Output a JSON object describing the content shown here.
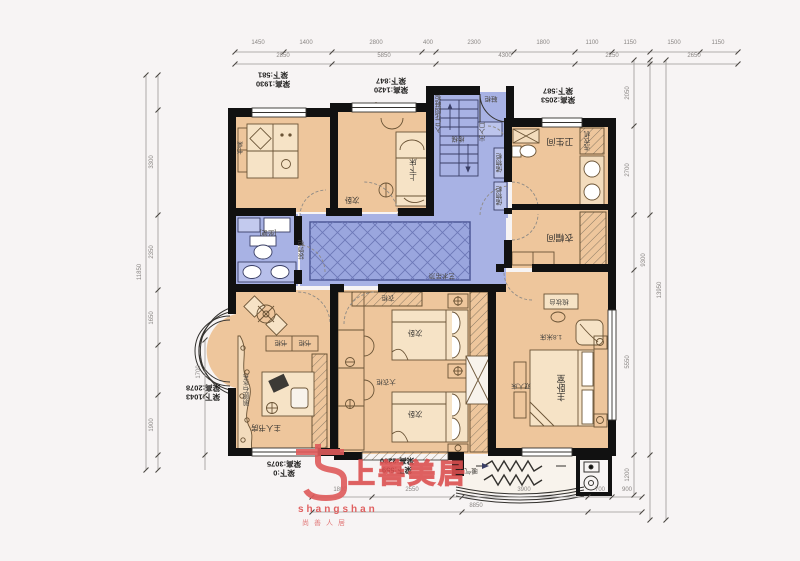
{
  "plan_title": "户型平面布置图",
  "labels": {
    "bath": "卫生间",
    "closet": "衣帽间",
    "bunk_bed": "上下床",
    "bedroom2": "次卧",
    "bed_a": "次卧",
    "bed_b": "次卧",
    "master": "主卧室",
    "study": "主人书房",
    "water": "鹅卵石水系",
    "wardrobe_big": "大衣柜",
    "wardrobe_top": "衣柜",
    "cabinet1": "储物柜",
    "cabinet2": "储物柜",
    "shoe": "鞋柜",
    "entry_col": "入户花园鞋柜",
    "service_door": "出入口",
    "stairs": "楼梯",
    "toilet": "[坐便]",
    "desk_small": "书桌",
    "display_cab": "装饰柜",
    "washer": "洗衣机",
    "dresser": "梳妆台",
    "bed_size": "1.8米床",
    "double_bed": "双人床",
    "radiator": "暖气片",
    "bookcase_a": "书柜",
    "bookcase_b": "书柜",
    "corridor_note": "艺术吊顶"
  },
  "beams": [
    {
      "line1": "梁高:1930",
      "line2": "梁下:581"
    },
    {
      "line1": "梁高:1420",
      "line2": "梁下:847"
    },
    {
      "line1": "梁高:2053",
      "line2": "梁下:587"
    },
    {
      "line1": "梁高:2078",
      "line2": "梁下:1043"
    },
    {
      "line1": "梁高:3075",
      "line2": "梁下:0"
    },
    {
      "line1": "梁高:2280",
      "line2": "梁下:559"
    }
  ],
  "logo": {
    "name": "上善美居",
    "latin": "shangshan",
    "tagline": "尚善人居"
  },
  "colors": {
    "room_fill": "#eec69c",
    "public_fill": "#a8b2e4",
    "rug_fill": "#9aa6de",
    "wall": "#111111",
    "logo_red": "#dd5555",
    "background": "#f7f4f4"
  },
  "dimensions": {
    "items": [
      {
        "x": 258,
        "y": 46,
        "v": "1450"
      },
      {
        "x": 306,
        "y": 46,
        "v": "1400"
      },
      {
        "x": 376,
        "y": 46,
        "v": "2800"
      },
      {
        "x": 428,
        "y": 46,
        "v": "400"
      },
      {
        "x": 474,
        "y": 46,
        "v": "2300"
      },
      {
        "x": 543,
        "y": 46,
        "v": "1800"
      },
      {
        "x": 592,
        "y": 46,
        "v": "1100"
      },
      {
        "x": 630,
        "y": 46,
        "v": "1150"
      },
      {
        "x": 674,
        "y": 46,
        "v": "1500"
      },
      {
        "x": 718,
        "y": 46,
        "v": "1150"
      },
      {
        "x": 283,
        "y": 59,
        "v": "2850"
      },
      {
        "x": 384,
        "y": 59,
        "v": "5850"
      },
      {
        "x": 505,
        "y": 59,
        "v": "4300"
      },
      {
        "x": 612,
        "y": 59,
        "v": "2250"
      },
      {
        "x": 694,
        "y": 59,
        "v": "2650"
      },
      {
        "x": 340,
        "y": 493,
        "v": "1800"
      },
      {
        "x": 412,
        "y": 493,
        "v": "2550"
      },
      {
        "x": 524,
        "y": 493,
        "v": "3900"
      },
      {
        "x": 600,
        "y": 493,
        "v": "700"
      },
      {
        "x": 627,
        "y": 493,
        "v": "900"
      },
      {
        "x": 476,
        "y": 509,
        "v": "8850"
      },
      {
        "x": 152,
        "y": 162,
        "v": "3300",
        "r": true
      },
      {
        "x": 152,
        "y": 252,
        "v": "2350",
        "r": true
      },
      {
        "x": 152,
        "y": 318,
        "v": "1650",
        "r": true
      },
      {
        "x": 152,
        "y": 425,
        "v": "1900",
        "r": true
      },
      {
        "x": 140,
        "y": 272,
        "v": "11850",
        "r": true
      },
      {
        "x": 199,
        "y": 372,
        "v": "1700",
        "r": true
      },
      {
        "x": 628,
        "y": 93,
        "v": "2050",
        "r": true
      },
      {
        "x": 628,
        "y": 170,
        "v": "2700",
        "r": true
      },
      {
        "x": 628,
        "y": 362,
        "v": "5550",
        "r": true
      },
      {
        "x": 628,
        "y": 475,
        "v": "1200",
        "r": true
      },
      {
        "x": 644,
        "y": 260,
        "v": "9300",
        "r": true
      },
      {
        "x": 660,
        "y": 290,
        "v": "13950",
        "r": true
      }
    ]
  }
}
